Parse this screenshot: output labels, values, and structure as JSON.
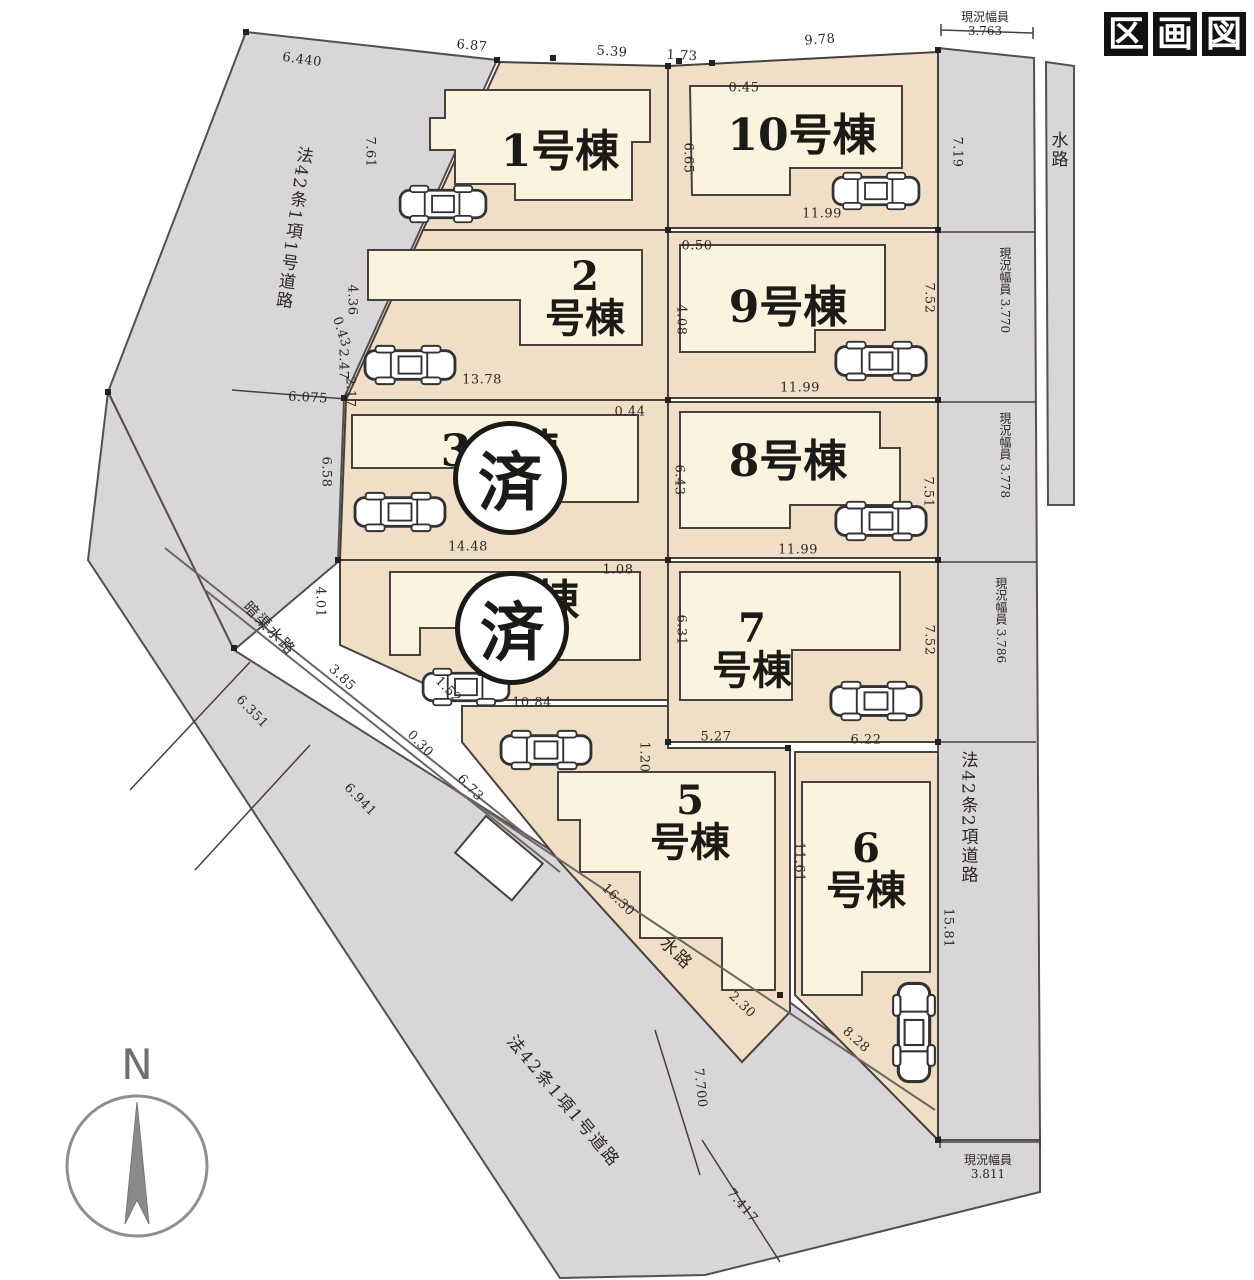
{
  "title": "区画図",
  "compass_label": "N",
  "sold_badge": "済",
  "lots": [
    {
      "name": "1号棟"
    },
    {
      "name": "2\n号棟"
    },
    {
      "name": "3号棟"
    },
    {
      "name": "4号棟"
    },
    {
      "name": "5\n号棟"
    },
    {
      "name": "6\n号棟"
    },
    {
      "name": "7\n号棟"
    },
    {
      "name": "8号棟"
    },
    {
      "name": "9号棟"
    },
    {
      "name": "10号棟"
    }
  ],
  "roads": {
    "left_road": "法42条1項1号道路",
    "bottom_road": "法42条1項1号道路",
    "right_road": "法42条2項道路",
    "top_waterway": "水路",
    "diagonal_waterway": "水路",
    "culvert_waterway": "暗渠水路"
  },
  "widths": {
    "label": "現況幅員",
    "top": "3.763",
    "right1": "3.770",
    "right2": "3.778",
    "right3": "3.786",
    "bottom": "3.811"
  },
  "dims": {
    "top_6440": "6.440",
    "top_687": "6.87",
    "top_539": "5.39",
    "top_173": "1.73",
    "top_978": "9.78",
    "left_761": "7.61",
    "left_436": "4.36",
    "left_043": "0.43",
    "left_247": "2.47",
    "left_217": "2.17",
    "left_6075": "6.075",
    "left_658": "6.58",
    "left_401": "4.01",
    "right_719": "7.19",
    "right_752a": "7.52",
    "right_751": "7.51",
    "right_752b": "7.52",
    "right_1581": "15.81",
    "lot10_045": "0.45",
    "lot10_665": "6.65",
    "lot10_1199": "11.99",
    "lot9_050": "0.50",
    "lot9_408": "4.08",
    "lot9_1199": "11.99",
    "lot2_1378": "13.78",
    "lot3_044": "0.44",
    "lot3_1448": "14.48",
    "lot8_643": "6.43",
    "lot8_1199": "11.99",
    "lot4_108": "1.08",
    "lot4_152": "1.52",
    "lot4_1084": "10.84",
    "lot7_631": "6.31",
    "lot7_527": "5.27",
    "lot7_622": "6.22",
    "lot5_120": "1.20",
    "lot6_1161": "11.61",
    "lot6_828": "8.28",
    "bottom_385": "3.85",
    "bottom_030": "0.30",
    "bottom_6351": "6.351",
    "bottom_6941": "6.941",
    "bottom_673": "6.73",
    "bottom_1630": "16.30",
    "bottom_230": "2.30",
    "bottom_7700": "7.700",
    "bottom_7417": "7.417"
  },
  "colors": {
    "road_gray": "#d8d6d9",
    "lot_fill": "#f0dfc6",
    "building_fill": "#faf3dd",
    "line": "#46413c"
  }
}
